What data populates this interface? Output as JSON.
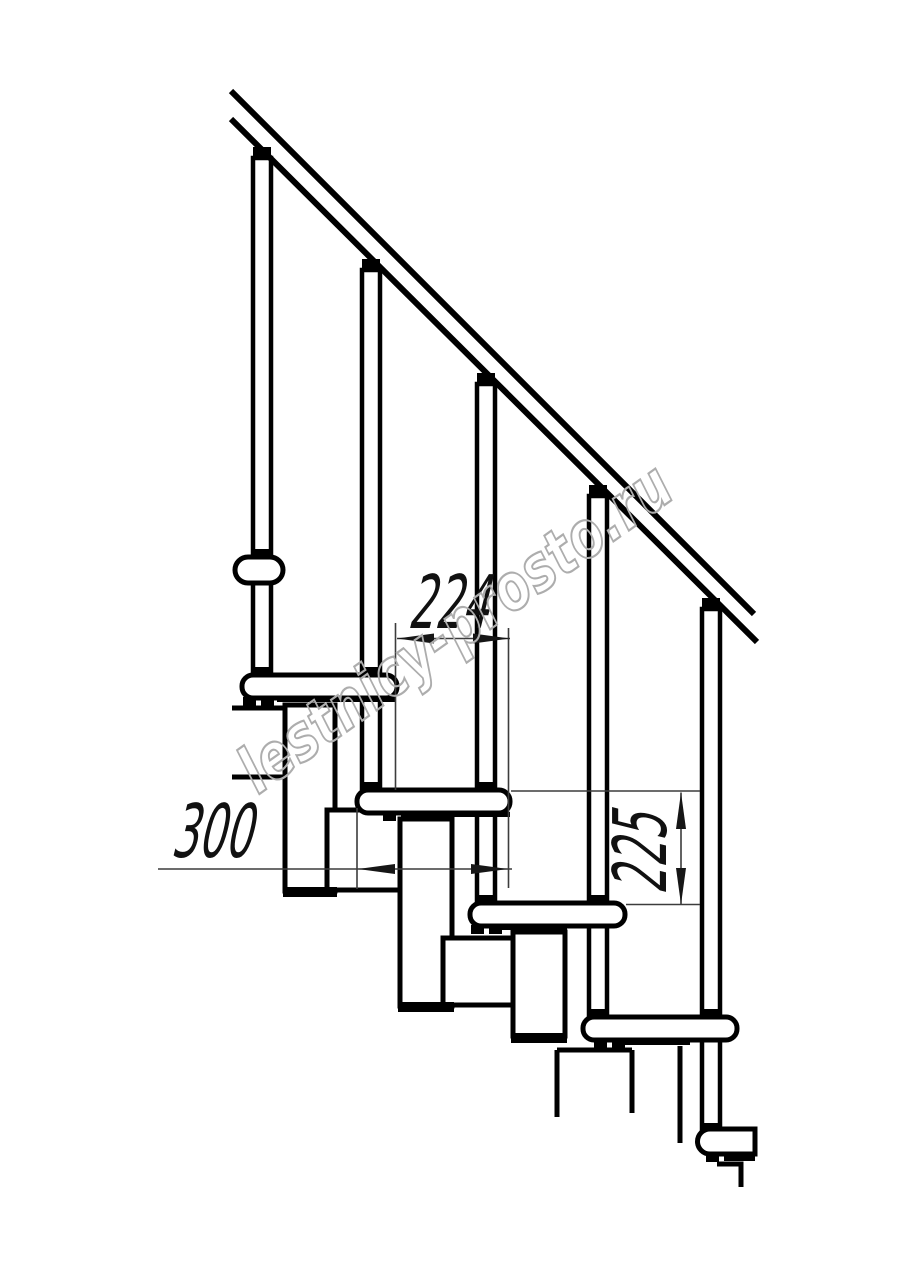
{
  "page": {
    "background": "#ffffff",
    "description": "Side elevation technical drawing of a modular staircase with handrail, balusters, treads and support modules"
  },
  "dimensions": {
    "step_run": "224",
    "step_length": "300",
    "riser_height": "225"
  },
  "watermark": {
    "text": "lestnicy-prosto.ru",
    "color": "#adadad"
  },
  "colors": {
    "line": "#000000",
    "dimension_line": "#3c3c3c",
    "dimension_text": "#111111",
    "background": "#ffffff"
  }
}
